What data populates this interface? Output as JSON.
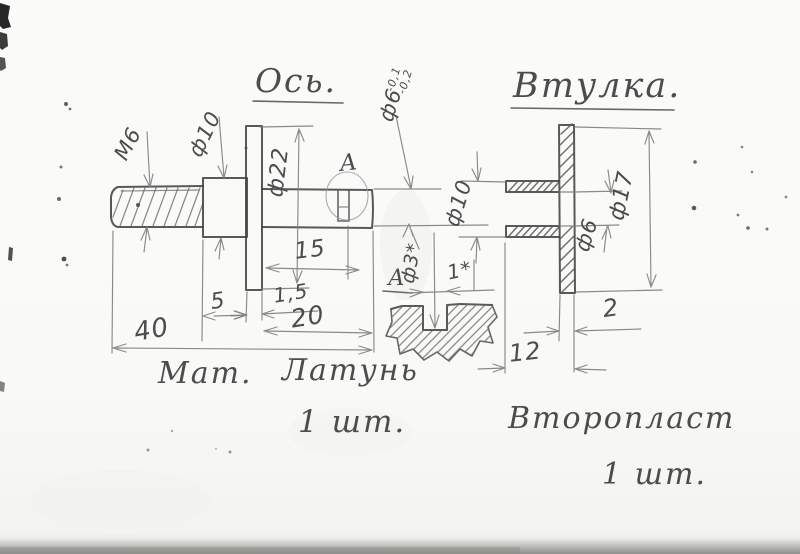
{
  "titles": {
    "shaft": "Ось.",
    "bushing": "Втулка."
  },
  "shaft": {
    "thread_label": "M6",
    "collar_dia": "ф10",
    "flange_dia": "ф22",
    "end_dia": "ф6",
    "end_tol_upper": "-0,1",
    "end_tol_lower": "-0,2",
    "groove_offset": "15",
    "flange_thickness": "1,5",
    "collar_length": "5",
    "front_length": "20",
    "total_length": "40",
    "detail_callout": "А"
  },
  "detail_view": {
    "label": "А",
    "slot_dia": "ф3*",
    "slot_width": "1*"
  },
  "bushing": {
    "tube_dia": "ф10",
    "bore_dia": "ф6",
    "flange_dia": "ф17",
    "flange_thickness": "2",
    "total_length": "12"
  },
  "notes": {
    "material_label": "Мат.",
    "shaft_material": "Латунь",
    "shaft_qty": "1 шт.",
    "bushing_material": "Второпласт",
    "bushing_qty": "1 шт."
  }
}
